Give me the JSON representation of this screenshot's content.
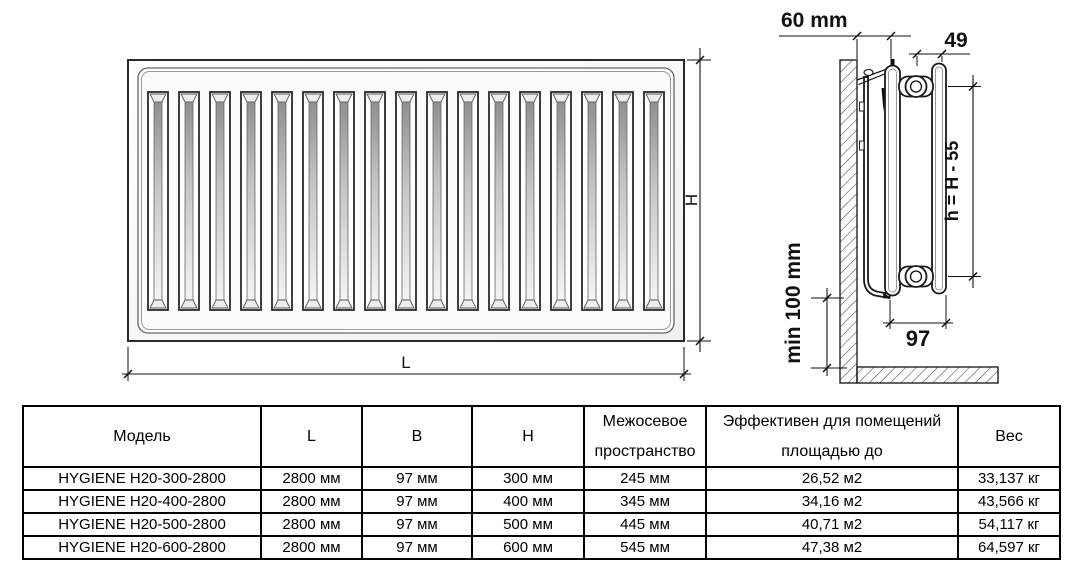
{
  "front_view": {
    "channel_count": 17,
    "labels": {
      "height": "H",
      "length": "L"
    }
  },
  "side_view": {
    "labels": {
      "wall_offset": "60 mm",
      "panel_gap": "49",
      "axis_height": "h = H - 55",
      "floor_clearance": "min 100 mm",
      "depth": "97"
    }
  },
  "table": {
    "headers": [
      "Модель",
      "L",
      "B",
      "H",
      "Межосевое пространство",
      "Эффективен для помещений площадью до",
      "Вес"
    ],
    "rows": [
      [
        "HYGIENE H20-300-2800",
        "2800 мм",
        "97 мм",
        "300 мм",
        "245 мм",
        "26,52 м2",
        "33,137 кг"
      ],
      [
        "HYGIENE H20-400-2800",
        "2800 мм",
        "97 мм",
        "400 мм",
        "345 мм",
        "34,16 м2",
        "43,566 кг"
      ],
      [
        "HYGIENE H20-500-2800",
        "2800 мм",
        "97 мм",
        "500 мм",
        "445 мм",
        "40,71 м2",
        "54,117 кг"
      ],
      [
        "HYGIENE H20-600-2800",
        "2800 мм",
        "97 мм",
        "600 мм",
        "545 мм",
        "47,38 м2",
        "64,597 кг"
      ]
    ]
  },
  "colors": {
    "line": "#111111",
    "text": "#000000",
    "background": "#ffffff"
  }
}
